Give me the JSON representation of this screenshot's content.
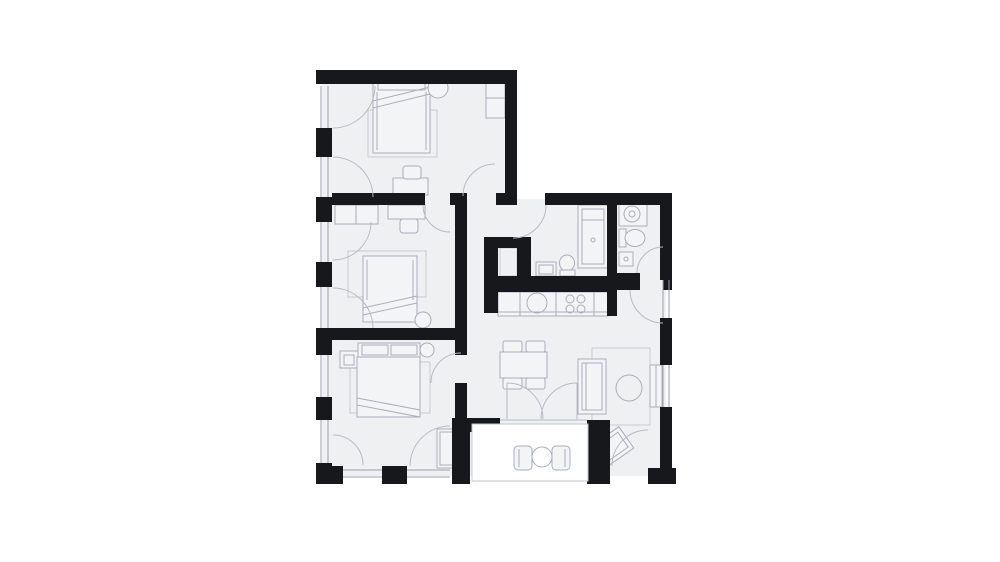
{
  "meta": {
    "kind": "architectural-floor-plan",
    "style": "black walls, light gray floor fill, thin gray furniture outlines, no text labels"
  },
  "canvas": {
    "width": 1000,
    "height": 562,
    "background": "#ffffff"
  },
  "colors": {
    "background": "#ffffff",
    "wall": "#17181c",
    "floor": "#eef0f2",
    "furniture_line": "#a9aeb8",
    "furniture_fill": "#f3f4f6",
    "rug_line": "#c6cad1",
    "door_arc_line": "#b7bcc4",
    "window_line": "#9aa0a8",
    "balcony_border": "#c2c6cc",
    "white": "#ffffff"
  },
  "inventory": {
    "rooms": [
      {
        "name": "bedroom-top",
        "furniture": [
          "double-bed",
          "headboard",
          "side-table-round",
          "rug",
          "desk",
          "desk-chair",
          "wardrobe"
        ]
      },
      {
        "name": "bedroom-middle",
        "furniture": [
          "wardrobe",
          "desk",
          "desk-chair",
          "double-bed",
          "rug",
          "round-pillow"
        ]
      },
      {
        "name": "bedroom-bottom",
        "furniture": [
          "headboard-with-pillows",
          "nightstand-with-lamp",
          "round-stool",
          "double-bed",
          "rug",
          "wardrobe"
        ]
      },
      {
        "name": "hallway",
        "furniture": []
      },
      {
        "name": "entry-shower-wc",
        "furniture": [
          "shower",
          "washbasin",
          "toilet",
          "duct-shaft"
        ]
      },
      {
        "name": "bathroom",
        "furniture": [
          "washing-machine",
          "toilet",
          "small-sink"
        ]
      },
      {
        "name": "kitchen",
        "furniture": [
          "counter",
          "round-sink",
          "cooktop-4-burners",
          "base-cabinets"
        ]
      },
      {
        "name": "living-dining",
        "furniture": [
          "dining-table",
          "dining-chairs-x4",
          "sofa",
          "rug",
          "coffee-table-round",
          "tv-bench",
          "armchair-rotated"
        ]
      },
      {
        "name": "balcony",
        "furniture": [
          "round-table",
          "chair-left",
          "chair-right"
        ]
      }
    ],
    "window_count": 10,
    "door_swing_count": 14
  }
}
